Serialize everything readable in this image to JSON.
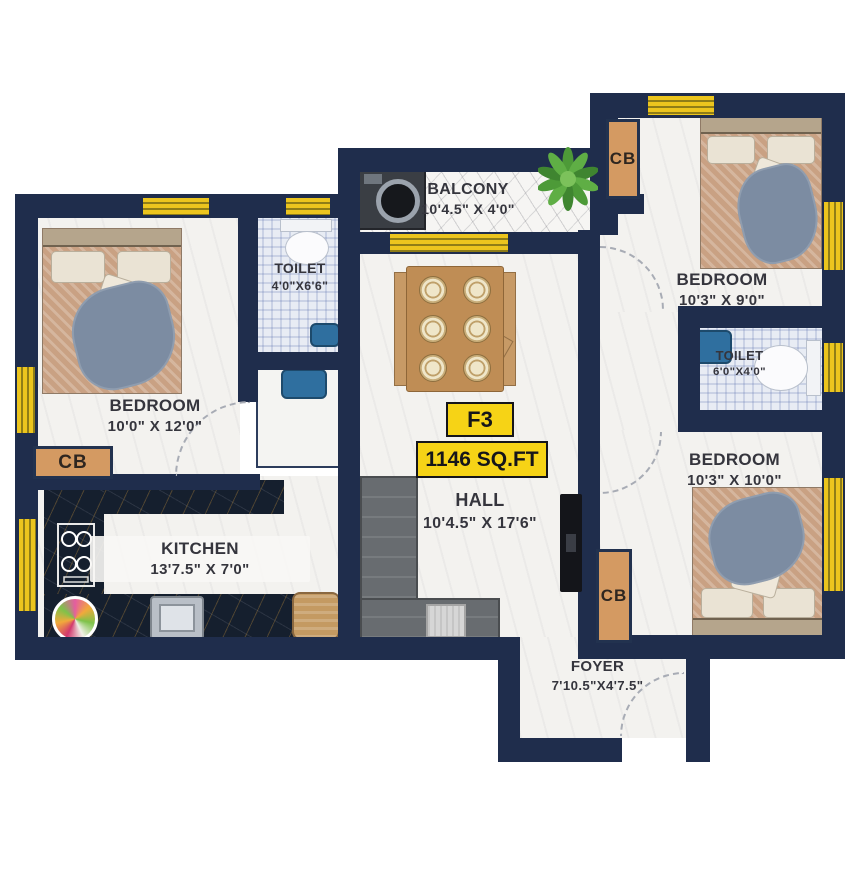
{
  "unit_badge": {
    "code": "F3",
    "area": "1146 SQ.FT"
  },
  "cupboard_label": "CB",
  "rooms": {
    "bedroom_left": {
      "name": "BEDROOM",
      "dims": "10'0\" X 12'0\""
    },
    "toilet_left": {
      "name": "TOILET",
      "dims": "4'0\"X6'6\""
    },
    "kitchen": {
      "name": "KITCHEN",
      "dims": "13'7.5\" X 7'0\""
    },
    "balcony": {
      "name": "BALCONY",
      "dims": "10'4.5\" X 4'0\""
    },
    "hall": {
      "name": "HALL",
      "dims": "10'4.5\" X 17'6\""
    },
    "foyer": {
      "name": "FOYER",
      "dims": "7'10.5\"X4'7.5\""
    },
    "bedroom_top_right": {
      "name": "BEDROOM",
      "dims": "10'3\" X 9'0\""
    },
    "toilet_right": {
      "name": "TOILET",
      "dims": "6'0\"X4'0\""
    },
    "bedroom_bottom_right": {
      "name": "BEDROOM",
      "dims": "10'3\" X 10'0\""
    }
  },
  "colors": {
    "wall": "#1f2d4c",
    "window_yellow": "#ecc51e",
    "badge_yellow": "#f6d316",
    "cupboard_tan": "#d49a62",
    "floor_light": "#f3f2ef",
    "counter_dark": "#151f2e"
  },
  "icons": {
    "bed-icon": "double bed top view",
    "sofa-icon": "L-shaped sofa",
    "dining-table-icon": "six seat dining table",
    "tv-icon": "wall mounted tv",
    "stove-icon": "four burner hob",
    "sink-icon": "kitchen sink",
    "basin-icon": "wash basin",
    "toilet-icon": "water closet",
    "washing-machine-icon": "washing machine",
    "plant-icon": "balcony plant",
    "basket-icon": "storage basket",
    "food-plate-icon": "food plate",
    "door-arc": "door swing arc",
    "window": "yellow window strip"
  }
}
